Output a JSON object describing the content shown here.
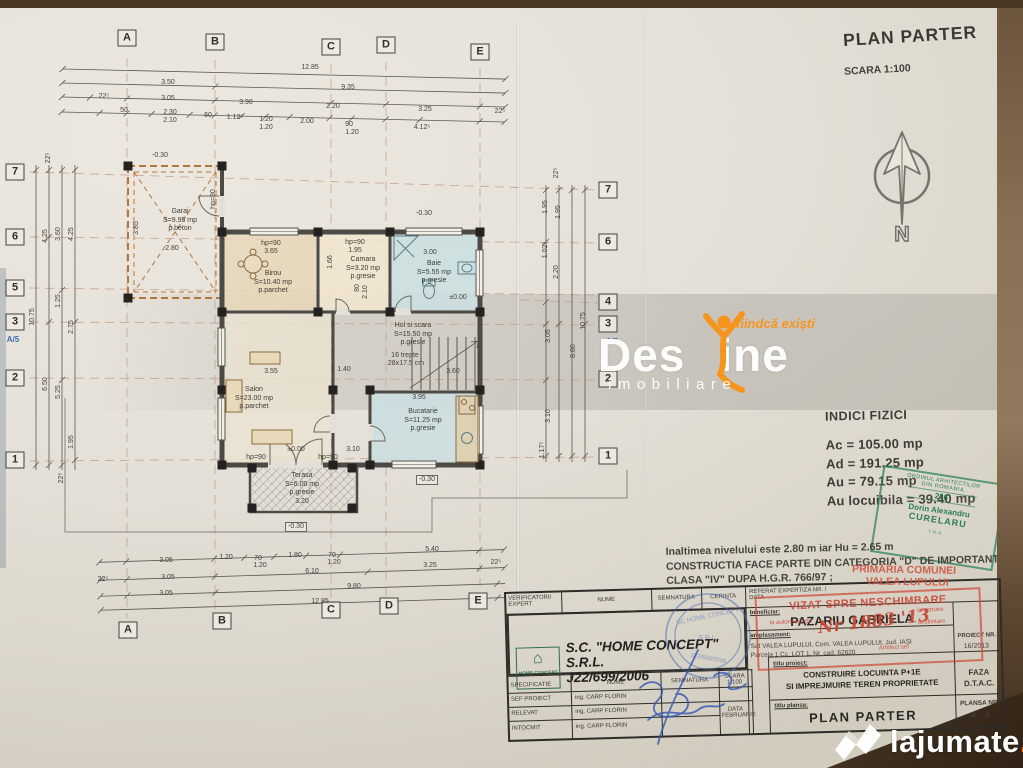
{
  "header": {
    "title": "PLAN PARTER",
    "scale": "SCARA 1:100",
    "north": "N"
  },
  "indici": {
    "title": "INDICI FIZICI",
    "rows": [
      {
        "label": "Ac =",
        "value": "105.00 mp"
      },
      {
        "label": "Ad =",
        "value": "191.25 mp"
      },
      {
        "label": "Au =",
        "value": "79.15 mp"
      },
      {
        "label": "Au locuibila =",
        "value": "39.40 mp"
      }
    ]
  },
  "notes": {
    "line1": "Inaltimea nivelului este 2.80 m  iar Hu = 2.65 m",
    "line2": "CONSTRUCTIA FACE PARTE DIN CATEGORIA \"D\" DE IMPORTANTA ;",
    "line3": "CLASA \"IV\" DUPA H.G.R. 766/97 ;"
  },
  "stamps": {
    "architect": {
      "org1": "ORDINUL ARHITECTILOR",
      "org2": "DIN ROMANIA",
      "number": "216",
      "name": "Dorin Alexandru",
      "surname": "CURELARU",
      "bottom": "T.N.A."
    },
    "primarie": {
      "line1": "PRIMĂRIA COMUNEI",
      "line2": "VALEA LUPULUI",
      "vizat": "VIZAT SPRE NESCHIMBARE",
      "aux1": "la autorizatia de",
      "aux2": "construire",
      "aux3": "desfiintare",
      "handwriting": "Nr 1883 '13",
      "signer": "Arhitect sef"
    },
    "company_round": {
      "t1": "SC HOME CONCEPT",
      "t2": "S.R.L.",
      "t3": "J22/699/2006"
    }
  },
  "watermark_destine": {
    "part1": "Des",
    "part2": "ine",
    "tagline": "fiindcă exiști",
    "sub": "imobiliare",
    "accent": "#f7941e"
  },
  "watermark_lajumate": {
    "name": "lajumate",
    "tld": ".ro",
    "accent": "#f26a21"
  },
  "title_block": {
    "h_verificatori": "VERIFICATORI/",
    "h_expert": "EXPERT",
    "h_nume": "NUME",
    "h_semnatura": "SEMNATURA",
    "h_cerinta": "CERINTA",
    "h_referat": "REFERAT EXPERTIZA NR. /",
    "h_referat2": "DATA",
    "logo_text": "HOME CONCEPT",
    "company_line1": "S.C.  \"HOME CONCEPT\" S.R.L.",
    "company_line2": "J22/699/2006",
    "beneficiar_label": "beneficiar:",
    "beneficiar": "PAZARIU GABRIELA",
    "amplasament_label": "amplasament:",
    "amplasament1": "Sat VALEA LUPULUI, Com. VALEA LUPULUI, Jud. IASI",
    "amplasament2": "Parcela 1 Cc, LOT 1, Nr. cad. 62620",
    "proiect_nr_label": "PROIECT NR.",
    "proiect_nr": "16/2013",
    "h_specificatie": "SPECIFICATIE",
    "h_nume2": "NUME",
    "h_semnatura2": "SEMNATURA",
    "scara_label": "SCARA",
    "scara_value": "1:100",
    "row1_label": "SEF PROIECT",
    "row1_name": "ing. CARP FLORIN",
    "row2_label": "RELEVAT",
    "row2_name": "ing. CARP FLORIN",
    "row3_label": "INTOCMIT",
    "row3_name": "ing. CARP FLORIN",
    "data_label": "DATA",
    "data_value": "FEBRUARIE",
    "titlu_proiect_label": "titlu proiect:",
    "titlu_proiect1": "CONSTRUIRE LOCUINTA P+1E",
    "titlu_proiect2": "SI IMPREJMUIRE TEREN PROPRIETATE",
    "faza_label": "FAZA",
    "faza_value": "D.T.A.C.",
    "titlu_plansa_label": "titlu plansa:",
    "titlu_plansa": "PLAN PARTER",
    "plansa_label": "PLANSA NR.",
    "plansa_value": "A - 4"
  },
  "plan": {
    "labels": [
      {
        "t": "A",
        "x": 127,
        "y": 38,
        "c": "g"
      },
      {
        "t": "B",
        "x": 215,
        "y": 42,
        "c": "g"
      },
      {
        "t": "C",
        "x": 331,
        "y": 47,
        "c": "g"
      },
      {
        "t": "D",
        "x": 386,
        "y": 45,
        "c": "g"
      },
      {
        "t": "E",
        "x": 480,
        "y": 52,
        "c": "g"
      },
      {
        "t": "A",
        "x": 128,
        "y": 630,
        "c": "g"
      },
      {
        "t": "B",
        "x": 222,
        "y": 621,
        "c": "g"
      },
      {
        "t": "C",
        "x": 331,
        "y": 610,
        "c": "g"
      },
      {
        "t": "D",
        "x": 389,
        "y": 606,
        "c": "g"
      },
      {
        "t": "E",
        "x": 478,
        "y": 601,
        "c": "g"
      },
      {
        "t": "7",
        "x": 15,
        "y": 172,
        "c": "g"
      },
      {
        "t": "6",
        "x": 15,
        "y": 237,
        "c": "g"
      },
      {
        "t": "5",
        "x": 15,
        "y": 288,
        "c": "g"
      },
      {
        "t": "3",
        "x": 15,
        "y": 322,
        "c": "g"
      },
      {
        "t": "2",
        "x": 15,
        "y": 378,
        "c": "g"
      },
      {
        "t": "1",
        "x": 15,
        "y": 460,
        "c": "g"
      },
      {
        "t": "7",
        "x": 608,
        "y": 190,
        "c": "g"
      },
      {
        "t": "6",
        "x": 608,
        "y": 242,
        "c": "g"
      },
      {
        "t": "4",
        "x": 608,
        "y": 302,
        "c": "g"
      },
      {
        "t": "3",
        "x": 608,
        "y": 324,
        "c": "g"
      },
      {
        "t": "2",
        "x": 608,
        "y": 379,
        "c": "g"
      },
      {
        "t": "1",
        "x": 608,
        "y": 456,
        "c": "g"
      },
      {
        "t": "A/5",
        "x": 13,
        "y": 340,
        "c": "b"
      },
      {
        "t": "A/5",
        "x": 612,
        "y": 342,
        "c": "b"
      },
      {
        "t": "12.85",
        "x": 310,
        "y": 68
      },
      {
        "t": "3.50",
        "x": 168,
        "y": 83
      },
      {
        "t": "9.35",
        "x": 348,
        "y": 88
      },
      {
        "t": "22⁵",
        "x": 104,
        "y": 97
      },
      {
        "t": "3.05",
        "x": 168,
        "y": 99
      },
      {
        "t": "3.90",
        "x": 246,
        "y": 103
      },
      {
        "t": "2.20",
        "x": 333,
        "y": 107
      },
      {
        "t": "3.25",
        "x": 425,
        "y": 110
      },
      {
        "t": "22⁵",
        "x": 500,
        "y": 112
      },
      {
        "t": "50",
        "x": 124,
        "y": 111
      },
      {
        "t": "2.30",
        "x": 170,
        "y": 113
      },
      {
        "t": "2.10",
        "x": 170,
        "y": 121
      },
      {
        "t": "60",
        "x": 208,
        "y": 116
      },
      {
        "t": "1.12⁵",
        "x": 235,
        "y": 118
      },
      {
        "t": "1.20",
        "x": 266,
        "y": 120
      },
      {
        "t": "1.20",
        "x": 266,
        "y": 128
      },
      {
        "t": "2.00",
        "x": 307,
        "y": 122
      },
      {
        "t": "90",
        "x": 349,
        "y": 125
      },
      {
        "t": "1.20",
        "x": 352,
        "y": 133
      },
      {
        "t": "4.12⁵",
        "x": 422,
        "y": 128
      },
      {
        "t": "3.05",
        "x": 166,
        "y": 561
      },
      {
        "t": "1.20",
        "x": 226,
        "y": 558
      },
      {
        "t": "70",
        "x": 258,
        "y": 559
      },
      {
        "t": "1.20",
        "x": 260,
        "y": 566
      },
      {
        "t": "1.80",
        "x": 295,
        "y": 556
      },
      {
        "t": "70",
        "x": 332,
        "y": 556
      },
      {
        "t": "1.20",
        "x": 334,
        "y": 563
      },
      {
        "t": "5.40",
        "x": 432,
        "y": 550
      },
      {
        "t": "22⁵",
        "x": 103,
        "y": 580
      },
      {
        "t": "3.05",
        "x": 168,
        "y": 578
      },
      {
        "t": "6.10",
        "x": 312,
        "y": 572
      },
      {
        "t": "3.25",
        "x": 430,
        "y": 566
      },
      {
        "t": "22⁵",
        "x": 496,
        "y": 563
      },
      {
        "t": "3.05",
        "x": 166,
        "y": 594
      },
      {
        "t": "9.80",
        "x": 354,
        "y": 587
      },
      {
        "t": "12.85",
        "x": 320,
        "y": 602
      },
      {
        "t": "22⁵",
        "x": 49,
        "y": 158,
        "r": -90
      },
      {
        "t": "4.25",
        "x": 46,
        "y": 236,
        "r": -90
      },
      {
        "t": "3.60",
        "x": 59,
        "y": 234,
        "r": -90
      },
      {
        "t": "4.25",
        "x": 72,
        "y": 234,
        "r": -90
      },
      {
        "t": "10.75",
        "x": 33,
        "y": 317,
        "r": -90
      },
      {
        "t": "1.25",
        "x": 59,
        "y": 301,
        "r": -90
      },
      {
        "t": "2.75",
        "x": 72,
        "y": 327,
        "r": -90
      },
      {
        "t": "6.50",
        "x": 46,
        "y": 384,
        "r": -90
      },
      {
        "t": "5.25",
        "x": 59,
        "y": 392,
        "r": -90
      },
      {
        "t": "1.95",
        "x": 72,
        "y": 442,
        "r": -90
      },
      {
        "t": "22⁵",
        "x": 62,
        "y": 478,
        "r": -90
      },
      {
        "t": "22⁵",
        "x": 557,
        "y": 173,
        "r": -90
      },
      {
        "t": "1.95",
        "x": 546,
        "y": 207,
        "r": -90
      },
      {
        "t": "1.95",
        "x": 559,
        "y": 212,
        "r": -90
      },
      {
        "t": "1.02⁵",
        "x": 546,
        "y": 250,
        "r": -90
      },
      {
        "t": "2.20",
        "x": 557,
        "y": 272,
        "r": -90
      },
      {
        "t": "10.75",
        "x": 584,
        "y": 321,
        "r": -90
      },
      {
        "t": "3.05",
        "x": 549,
        "y": 336,
        "r": -90
      },
      {
        "t": "8.80",
        "x": 574,
        "y": 351,
        "r": -90
      },
      {
        "t": "3.10",
        "x": 549,
        "y": 416,
        "r": -90
      },
      {
        "t": "1.17⁵",
        "x": 543,
        "y": 450,
        "r": -90
      },
      {
        "t": "-0.30",
        "x": 160,
        "y": 156
      },
      {
        "t": "-0.30",
        "x": 424,
        "y": 214
      },
      {
        "t": "2.80",
        "x": 172,
        "y": 249
      },
      {
        "t": "3.85",
        "x": 137,
        "y": 228,
        "r": -90
      },
      {
        "t": "hp=90",
        "x": 214,
        "y": 199,
        "r": -90
      },
      {
        "t": "hp=90",
        "x": 271,
        "y": 244
      },
      {
        "t": "3.65",
        "x": 271,
        "y": 252
      },
      {
        "t": "hp=90",
        "x": 355,
        "y": 243
      },
      {
        "t": "1.95",
        "x": 355,
        "y": 251
      },
      {
        "t": "3.00",
        "x": 430,
        "y": 253
      },
      {
        "t": "1.66",
        "x": 331,
        "y": 262,
        "r": -90
      },
      {
        "t": "80",
        "x": 358,
        "y": 288,
        "r": -90
      },
      {
        "t": "2.10",
        "x": 366,
        "y": 292,
        "r": -90
      },
      {
        "t": "±0.00",
        "x": 458,
        "y": 298
      },
      {
        "t": "±0.00",
        "x": 296,
        "y": 450
      },
      {
        "t": "3.55",
        "x": 271,
        "y": 372
      },
      {
        "t": "1.40",
        "x": 344,
        "y": 370
      },
      {
        "t": "3.95",
        "x": 419,
        "y": 398
      },
      {
        "t": "3.10",
        "x": 353,
        "y": 450
      },
      {
        "t": "3.60",
        "x": 453,
        "y": 372
      },
      {
        "t": "16 trepte",
        "x": 405,
        "y": 356
      },
      {
        "t": "28x17.5 cm",
        "x": 406,
        "y": 364
      },
      {
        "t": "hp=90",
        "x": 256,
        "y": 458
      },
      {
        "t": "hp=90",
        "x": 328,
        "y": 458
      },
      {
        "t": "-0.30",
        "x": 427,
        "y": 480,
        "c": "dx"
      },
      {
        "t": "-0.30",
        "x": 296,
        "y": 527,
        "c": "dx"
      },
      {
        "t": "Garaj\nS=9.95 mp\np.beton",
        "x": 180,
        "y": 208,
        "c": "r"
      },
      {
        "t": "Birou\nS=10.40 mp\np.parchet",
        "x": 273,
        "y": 270,
        "c": "r"
      },
      {
        "t": "Camara\nS=3.20 mp\np.gresie",
        "x": 363,
        "y": 256,
        "c": "r"
      },
      {
        "t": "Baie\nS=5.55 mp\np.gresie",
        "x": 434,
        "y": 260,
        "c": "r"
      },
      {
        "t": "Hol si scara\nS=15.50 mp\np.gresie",
        "x": 413,
        "y": 322,
        "c": "r"
      },
      {
        "t": "Salon\nS=23.00 mp\np.parchet",
        "x": 254,
        "y": 386,
        "c": "r"
      },
      {
        "t": "Bucatarie\nS=11.25 mp\np.gresie",
        "x": 423,
        "y": 408,
        "c": "r"
      },
      {
        "t": "Terasa\nS=6.00 mp\np.gresie\n3.20",
        "x": 302,
        "y": 472,
        "c": "r"
      }
    ]
  }
}
